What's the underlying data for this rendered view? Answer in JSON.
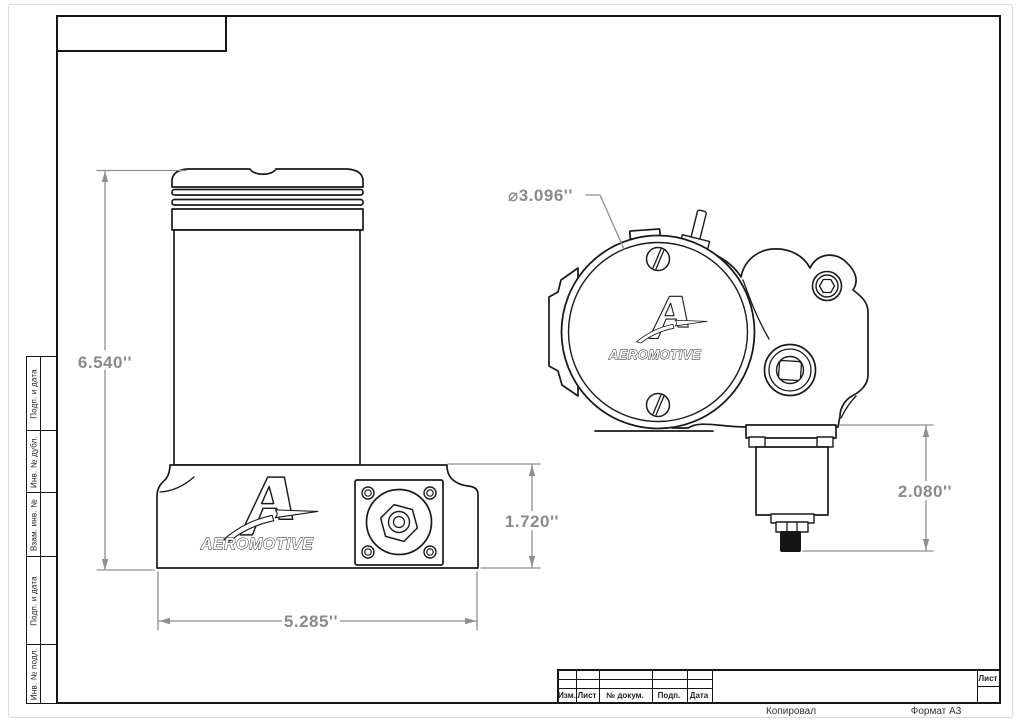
{
  "drawing": {
    "brand": "AEROMOTIVE",
    "dims": {
      "front_height": "6.540''",
      "front_width": "5.285''",
      "front_outlet_height": "1.720''",
      "side_diameter": "⌀3.096''",
      "side_regulator_height": "2.080''"
    }
  },
  "side_column": {
    "cells": [
      "Подп. и дата",
      "Инв. № дубл.",
      "Взам. инв. №",
      "Подп. и дата",
      "Инв. № подл."
    ]
  },
  "title_block": {
    "columns": [
      "Изм.",
      "Лист",
      "№ докум.",
      "Подп.",
      "Дата"
    ],
    "sheet_label": "Лист"
  },
  "footer": {
    "copied": "Копировал",
    "format": "Формат A3"
  },
  "colors": {
    "line": "#1a1a1a",
    "dim": "#8f8f8f"
  }
}
